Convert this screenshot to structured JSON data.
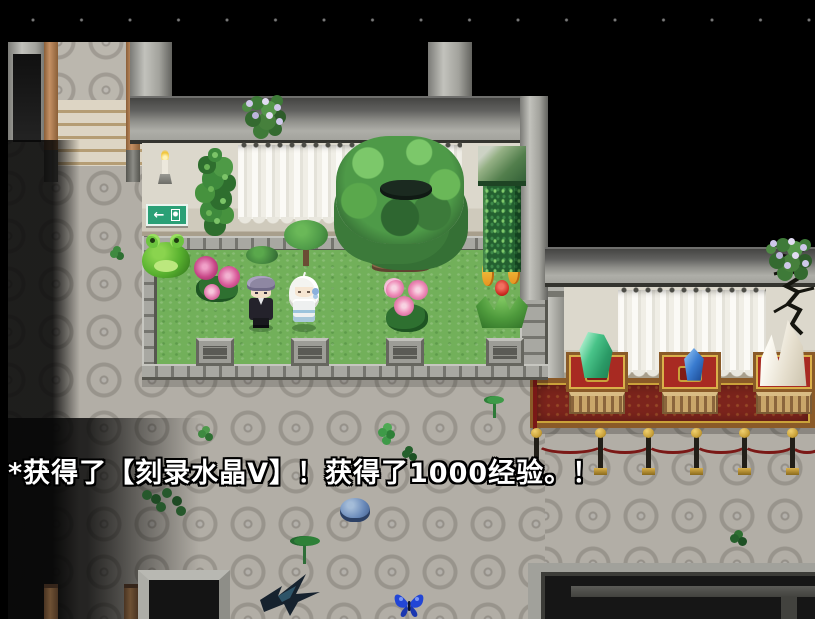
{
  "game": {
    "message": "*获得了【刻录水晶Ⅴ】！获得了1000经验。！",
    "exit_sign": {
      "arrow": "←"
    },
    "experience_gained": "1000",
    "item_obtained": "刻录水晶Ⅴ",
    "palette": {
      "night": "#000000",
      "floor_gray": "#b2aea6",
      "grass_green": "#72b05a",
      "wall_dark": "#61615f",
      "wall_light": "#aeaea8",
      "beige_wall": "#dcd8cc",
      "curtain_white": "#f0eee6",
      "carpet_red": "#7c241c",
      "carpet_trim_brown": "#8a5a28",
      "rope_red": "#7a1816",
      "gold": "#d9b04a",
      "exit_sign_green": "#2aa076",
      "crystal_green": "#49c489",
      "crystal_blue": "#3a7cd0",
      "crystal_white": "#f3efe4",
      "slime_blue": "#6888b8",
      "butterfly_blue": "#2246d6"
    }
  }
}
